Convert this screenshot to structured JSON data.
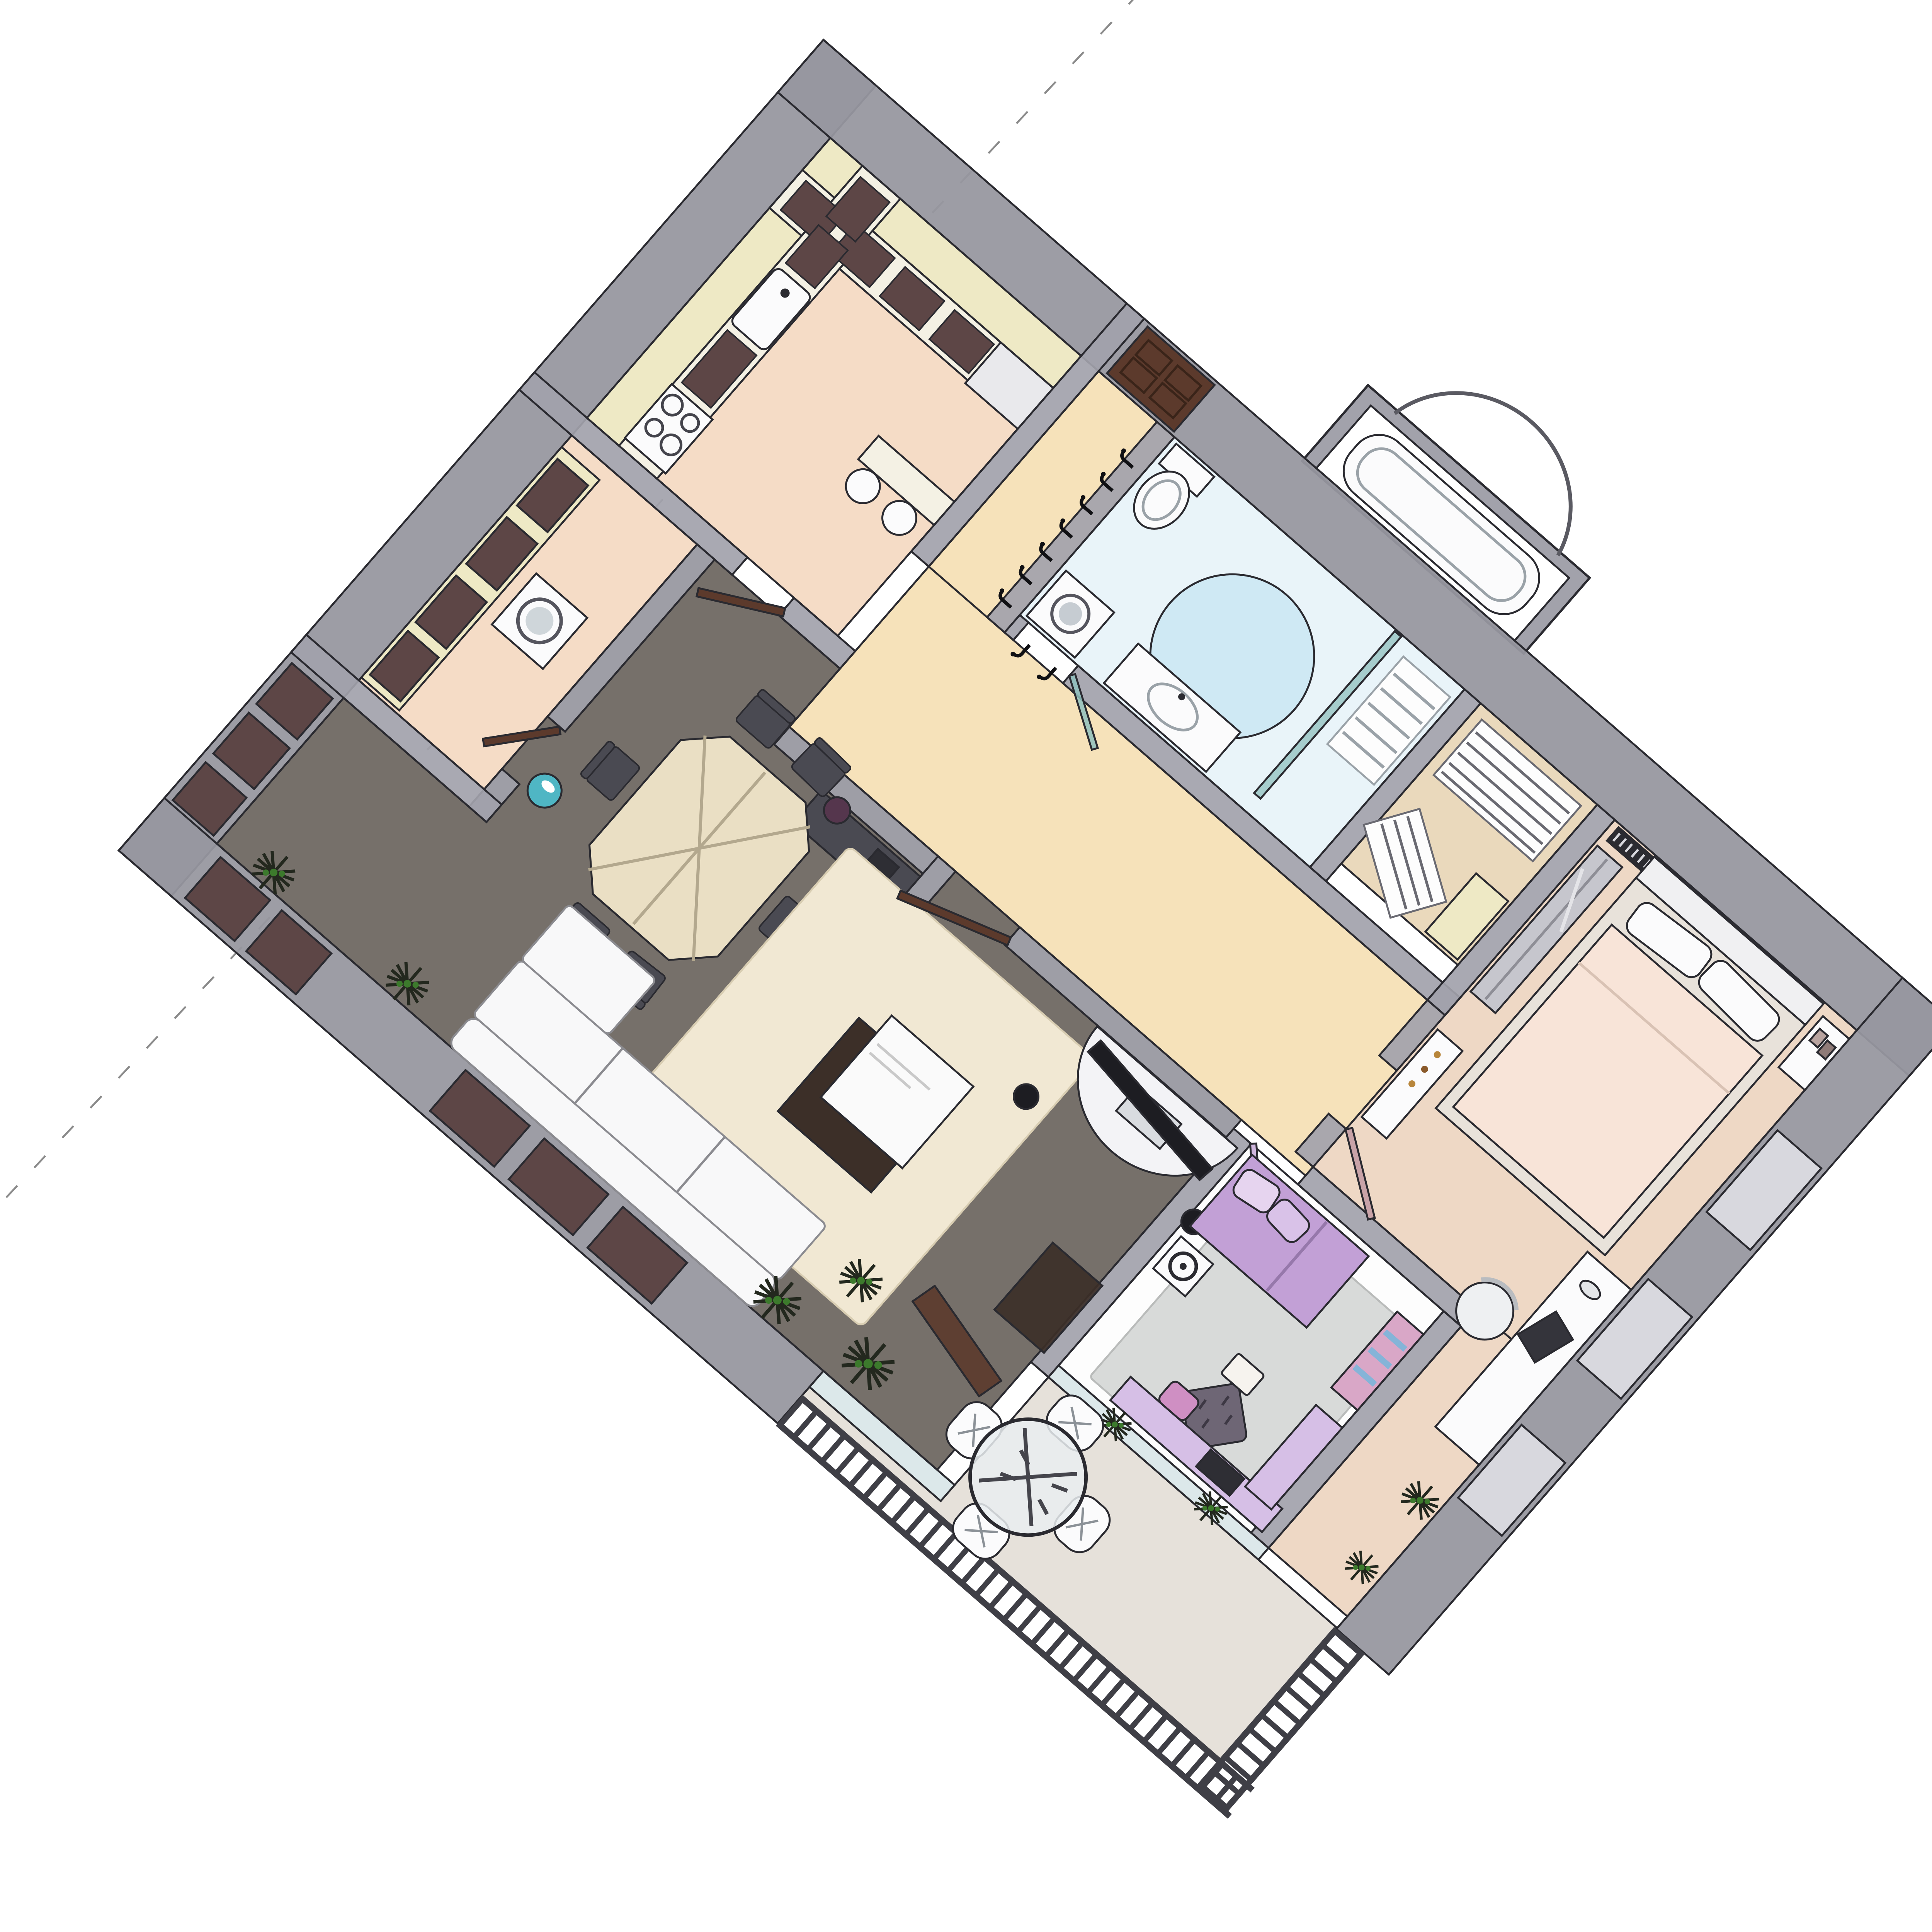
{
  "scene": {
    "type": "isometric-3d-floor-plan",
    "style": "sketchup-render",
    "background": "#ffffff",
    "view_rotation_deg": 41,
    "construction_line": {
      "style": "dashed",
      "color": "#8a8a8a"
    }
  },
  "palette": {
    "wall": "#a2a2ab",
    "wall_outer": "#97979f",
    "wall_light": "#c7c7ce",
    "outline": "#2a2a30",
    "floor_kitchen": "#f5dcc6",
    "floor_hall": "#f6e2ba",
    "floor_bath": "#e9f4f9",
    "rug_bath": "#cfe9f4",
    "floor_closet": "#ead9bc",
    "floor_bedroom": "#eed8c5",
    "bed_duvet": "#f8e4d8",
    "bed_frame": "#e8e2da",
    "floor_dark": "#76706a",
    "rug_cream": "#f1e8d3",
    "floor_kid": "#fdfdfd",
    "rug_kid": "#d8dad9",
    "purple_bed": "#c2a0d6",
    "lavender": "#d6bfe6",
    "pink_accent": "#d9a7c7",
    "blue_shelf": "#85b4d8",
    "floor_balcony": "#e6e1da",
    "cabinet_cream": "#eee9c5",
    "cabinet_front": "#5d4646",
    "counter_top": "#f4f1e4",
    "door_brown": "#5c3a2c",
    "door_pink": "#c9a3a8",
    "door_lavender": "#cfb6dd",
    "glass_teal": "#8fc0bd",
    "glass_light": "#dce8ea",
    "railing": "#3f3f46",
    "plant_dark": "#23281e",
    "plant_green": "#3c7a2c",
    "appliance_white": "#fbfbfc",
    "sofa_white": "#f8f8f9",
    "furniture_dark": "#4a4a52",
    "speaker_black": "#1d1d22",
    "table_cream": "#eadfc4",
    "wood_dark": "#3c2f28",
    "radiator": "#2b2b31",
    "teal_vase": "#49c2d4",
    "white": "#ffffff"
  },
  "rooms": [
    {
      "id": "kitchen",
      "label": "kitchen",
      "floor": "#f5dcc6",
      "furniture": [
        "l-shaped-counter",
        "upper-cabinets",
        "sink",
        "stove-4-burners",
        "peninsula",
        "two-stools",
        "fridge-unit"
      ]
    },
    {
      "id": "laundry",
      "label": "utility room",
      "floor": "#f5dcc6",
      "furniture": [
        "cabinets",
        "washing-machine"
      ]
    },
    {
      "id": "dining",
      "label": "dining room",
      "floor": "#76706a",
      "furniture": [
        "octagonal-table",
        "six-chairs",
        "sideboard",
        "telephone",
        "plant-pot",
        "teal-vase",
        "windows"
      ]
    },
    {
      "id": "living",
      "label": "living room",
      "floor": "#76706a",
      "furniture": [
        "sectional-sofa",
        "shag-rug",
        "coffee-table",
        "curved-tv-stand",
        "tv",
        "speakers",
        "brown-cabinet",
        "plants"
      ]
    },
    {
      "id": "hallway",
      "label": "hallway",
      "floor": "#f6e2ba",
      "furniture": [
        "coat-hooks",
        "entry-door"
      ]
    },
    {
      "id": "bathroom",
      "label": "bathroom",
      "floor": "#e9f4f9",
      "furniture": [
        "toilet",
        "round-blue-rug",
        "sink-vanity",
        "washing-machine",
        "glass-partition",
        "arched-tub-niche",
        "towel-rack"
      ]
    },
    {
      "id": "closet",
      "label": "walk-in closet",
      "floor": "#ead9bc",
      "furniture": [
        "slatted-shelf-racks",
        "shelving"
      ]
    },
    {
      "id": "bedroom",
      "label": "master bedroom",
      "floor": "#eed8c5",
      "furniture": [
        "double-bed",
        "headboard",
        "pillows",
        "radiator",
        "sliding-wardrobe",
        "dresser",
        "nightstand",
        "photo-frames",
        "desk",
        "laptop",
        "tufted-chair",
        "windows"
      ]
    },
    {
      "id": "kids-room",
      "label": "kids room",
      "floor": "#fdfdfd",
      "furniture": [
        "purple-bed",
        "gray-rug",
        "tufted-ottoman",
        "desk",
        "tv",
        "bookshelf",
        "wardrobe",
        "appliance"
      ]
    },
    {
      "id": "balcony",
      "label": "balcony",
      "floor": "#e6e1da",
      "furniture": [
        "round-glass-table",
        "four-white-chairs",
        "wooden-bench",
        "plants",
        "metal-railing"
      ]
    }
  ]
}
